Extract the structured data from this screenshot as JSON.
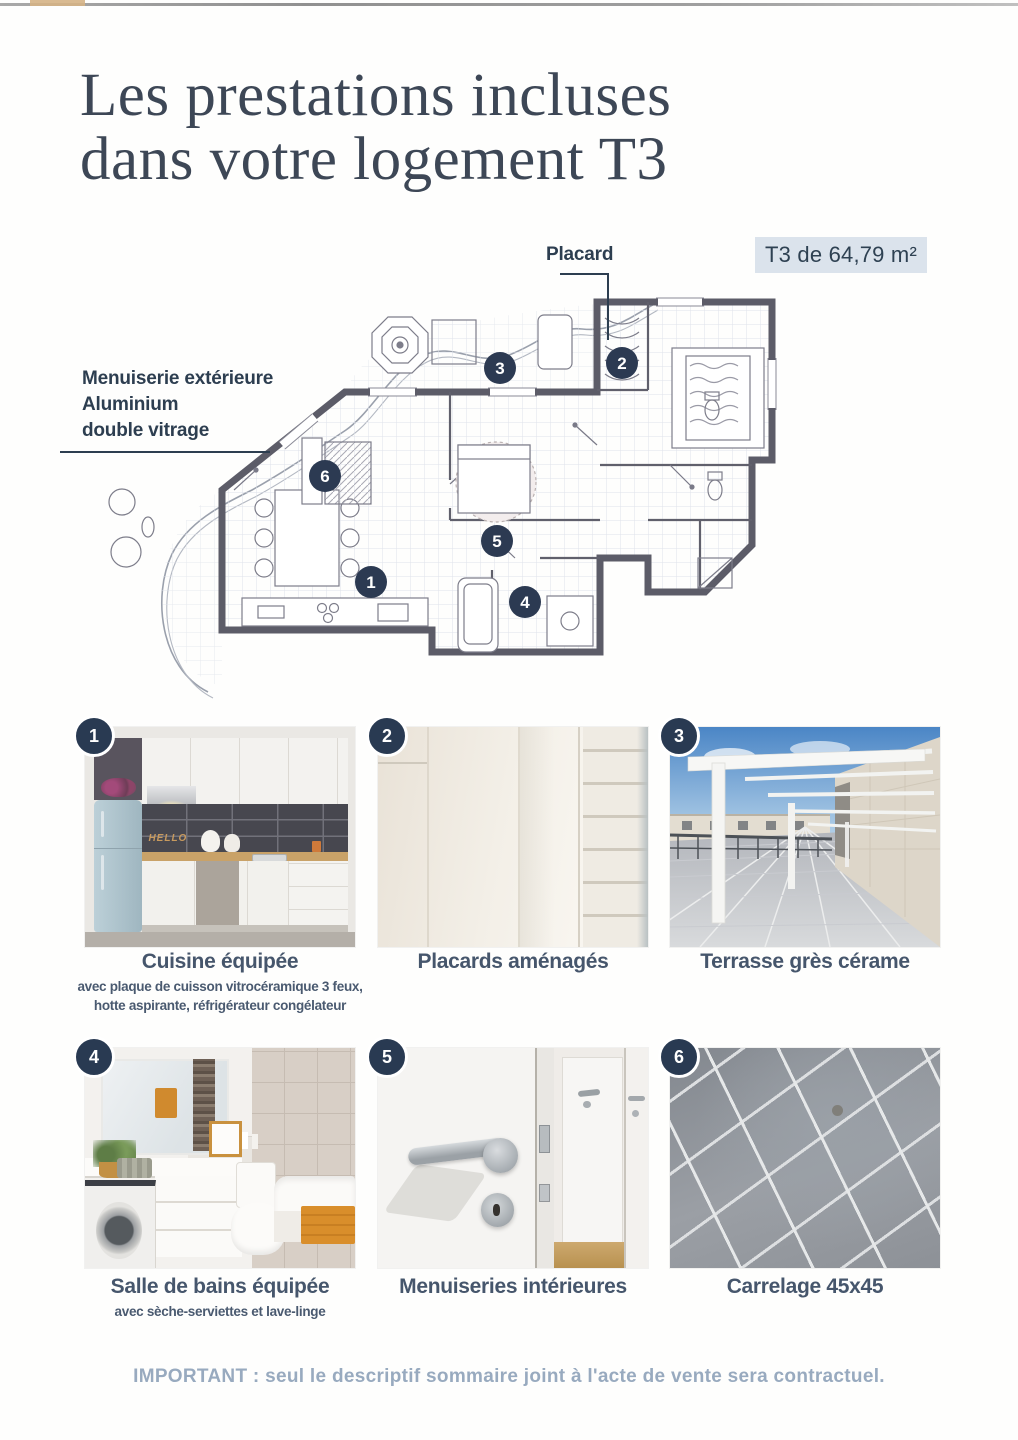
{
  "page": {
    "title_line1": "Les prestations incluses",
    "title_line2": "dans votre logement T3",
    "area_badge": "T3 de 64,79 m²",
    "footer": "IMPORTANT : seul le descriptif sommaire joint à l'acte de vente sera contractuel."
  },
  "floor_plan": {
    "placard_label": "Placard",
    "menuiserie_label": {
      "line1": "Menuiserie extérieure",
      "line2": "Aluminium",
      "line3": "double vitrage"
    },
    "markers": {
      "m1": "1",
      "m2": "2",
      "m3": "3",
      "m4": "4",
      "m5": "5",
      "m6": "6"
    }
  },
  "features": [
    {
      "number": "1",
      "title": "Cuisine équipée",
      "subtitle": "avec plaque de cuisson vitrocéramique 3 feux, hotte aspirante, réfrigérateur congélateur",
      "photo_text": "HELLO"
    },
    {
      "number": "2",
      "title": "Placards aménagés",
      "subtitle": ""
    },
    {
      "number": "3",
      "title": "Terrasse grès cérame",
      "subtitle": ""
    },
    {
      "number": "4",
      "title": "Salle de bains équipée",
      "subtitle": "avec sèche-serviettes et lave-linge"
    },
    {
      "number": "5",
      "title": "Menuiseries intérieures",
      "subtitle": ""
    },
    {
      "number": "6",
      "title": "Carrelage 45x45",
      "subtitle": ""
    }
  ],
  "colors": {
    "marker_navy": "#2c3a52",
    "title_text": "#3d4756",
    "badge_bg": "#dbe3ec",
    "caption_text": "#46566c",
    "footer_text": "#98aabf",
    "plan_wall": "#5c5c68"
  }
}
